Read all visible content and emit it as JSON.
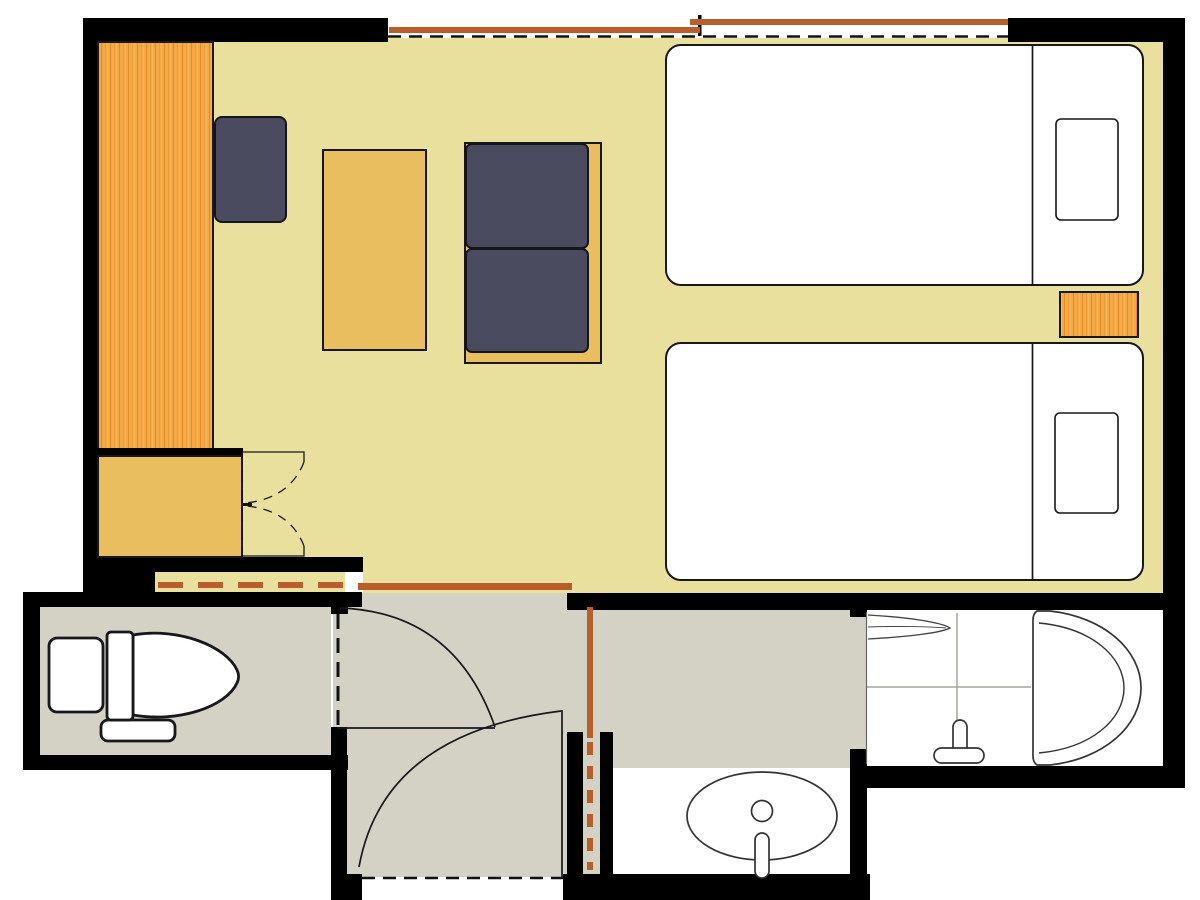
{
  "diagram": {
    "type": "floor-plan",
    "subject": "hotel twin guest room with toilet, entry hall, vanity washroom and unit bathroom",
    "rooms": [
      {
        "id": "guest-room",
        "label": "Guest room (twin)",
        "floor_color": "#e9e09e"
      },
      {
        "id": "toilet-room",
        "label": "Toilet room",
        "floor_color": "#d4d2c5"
      },
      {
        "id": "entry-hall",
        "label": "Entry hall",
        "floor_color": "#d4d2c5"
      },
      {
        "id": "washroom",
        "label": "Washroom / vanity",
        "floor_color": "#d4d2c5"
      },
      {
        "id": "bathroom",
        "label": "Bathroom (tub & shower)",
        "floor_color": "#ffffff"
      }
    ],
    "furniture": [
      {
        "id": "wardrobe",
        "label": "Wardrobe cabinet"
      },
      {
        "id": "closet",
        "label": "Closet with bifold door"
      },
      {
        "id": "lounge-chair",
        "label": "Chair"
      },
      {
        "id": "side-table",
        "label": "Table"
      },
      {
        "id": "sofa",
        "label": "Two-seat sofa"
      },
      {
        "id": "bed-1",
        "label": "Bed 1 with pillow"
      },
      {
        "id": "bed-2",
        "label": "Bed 2 with pillow"
      },
      {
        "id": "nightstand",
        "label": "Nightstand"
      }
    ],
    "fixtures": [
      {
        "id": "toilet",
        "label": "Toilet with tank"
      },
      {
        "id": "vanity-sink",
        "label": "Oval vanity sink with faucet"
      },
      {
        "id": "bathtub",
        "label": "Bathtub"
      },
      {
        "id": "shower-mixer",
        "label": "Shower mixer tap"
      },
      {
        "id": "bath-shelf",
        "label": "Bath counter shelf"
      }
    ],
    "openings": [
      {
        "id": "window",
        "label": "Sliding window, two overlapping sashes"
      },
      {
        "id": "partition-sliding-door",
        "label": "Sliding partition (dashed track)"
      },
      {
        "id": "hall-sliding-door",
        "label": "Sliding door between room and hall"
      },
      {
        "id": "washroom-sliding-door",
        "label": "Sliding door to washroom"
      },
      {
        "id": "toilet-swing-door",
        "label": "Toilet swing door with arc"
      },
      {
        "id": "entry-swing-door",
        "label": "Entrance swing door with arc"
      },
      {
        "id": "closet-bifold-door",
        "label": "Closet bifold door"
      },
      {
        "id": "entrance-threshold",
        "label": "Entrance threshold (dashed)"
      }
    ]
  },
  "palette": {
    "wall": "#000000",
    "floor_main": "#e9e09e",
    "floor_service": "#d4d2c5",
    "wood": "#f6a946",
    "wood_grain": "#df8f28",
    "furniture_tan": "#e9be5f",
    "upholstery_navy": "#4b4b60",
    "door_sienna": "#b95d2a",
    "outline_dark": "#17171c",
    "grid_gray": "#a6a69b",
    "fixture_white": "#ffffff"
  }
}
